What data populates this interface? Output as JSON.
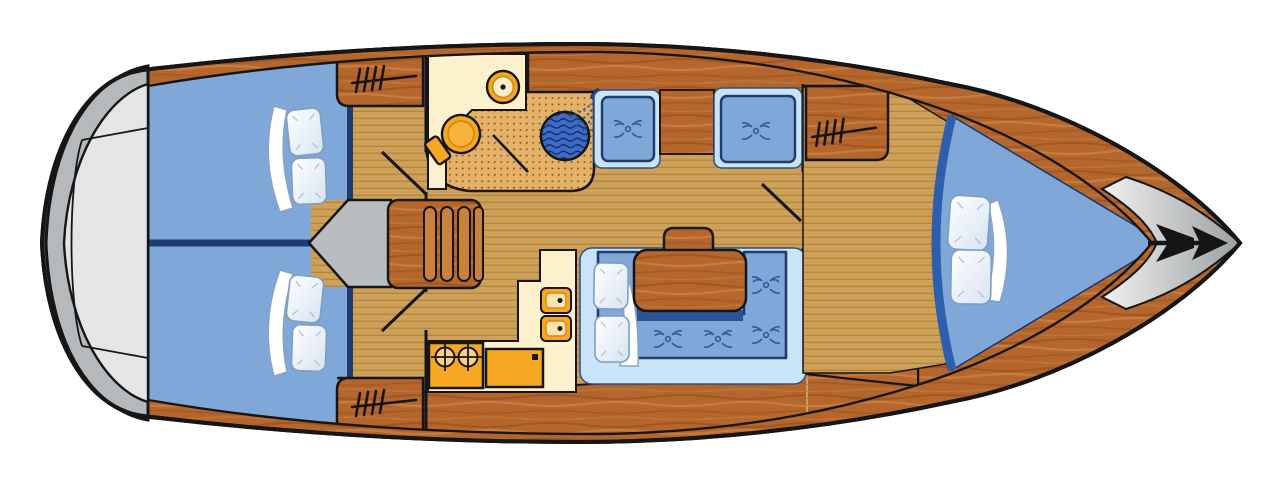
{
  "app": {
    "title": "Sailing yacht interior floor plan (top view, bow to the right)"
  },
  "diagram": {
    "type": "floor-plan",
    "subject": "Monohull sailing yacht deck / accommodation plan",
    "orientation": {
      "bow": "right",
      "stern": "left"
    },
    "colors": {
      "outline": "#161616",
      "wood_base": "#b4662c",
      "wood_streak_dark": "#8f4b1a",
      "wood_streak_light": "#d18a4a",
      "floor_base": "#cda159",
      "floor_stripe": "#b7853d",
      "stipple_base": "#e3b167",
      "stipple_dot": "#7c501a",
      "cream": "#fcf0cd",
      "fixture_orange": "#f6a823",
      "fixture_light": "#fde4ae",
      "bed_blue": "#7fa7d8",
      "seat_back_blue": "#c9e4f6",
      "navy": "#1e3c72",
      "navy_mid": "#2e5fae",
      "shower_blue": "#3f6cc0",
      "shower_wave": "#10307e",
      "table_shadow": "#2c5396",
      "platform_gray": "#b6b9bb",
      "platform_inner_gray": "#e4e5e6",
      "companionway_gray": "#babdbf",
      "bow_gray_light": "#f0f0f0",
      "bow_gray_dark": "#9ba0a2",
      "pillow_white": "#ffffff",
      "pillow_shade": "#d6e3f0",
      "pillow_edge": "#7f9ec0",
      "anchor_black": "#151515"
    },
    "areas": [
      {
        "id": "swim_platform",
        "label": "Stern swim platform"
      },
      {
        "id": "aft_cabin_port",
        "label": "Aft double cabin (port)",
        "furniture": [
          "double berth",
          "2 pillows",
          "folded blanket",
          "wardrobe"
        ]
      },
      {
        "id": "aft_cabin_starboard",
        "label": "Aft double cabin (starboard)",
        "furniture": [
          "double berth",
          "2 pillows",
          "folded blanket",
          "wardrobe"
        ]
      },
      {
        "id": "companionway",
        "label": "Companionway steps with entry arrow"
      },
      {
        "id": "head_aft",
        "label": "Aft head: toilet, washbasin, separate shower"
      },
      {
        "id": "salon",
        "label": "Salon: U-shaped settee with table, two facing seats with cabinet"
      },
      {
        "id": "galley",
        "label": "L-shaped galley: twin sink, 2-burner stove, icebox/counter"
      },
      {
        "id": "head_forward",
        "label": "Forward head: toilet and washbasin"
      },
      {
        "id": "forward_cabin",
        "label": "Forward V-berth cabin with wardrobe"
      },
      {
        "id": "bow_deck",
        "label": "Bow deck with anchor"
      }
    ],
    "icons": [
      "anchor-icon",
      "hanger-icon",
      "toilet-icon",
      "washbasin-icon",
      "shower-icon",
      "shower-head-icon",
      "stove-burner-icon",
      "sink-icon",
      "tuft-icon",
      "companionway-arrow-icon"
    ]
  }
}
